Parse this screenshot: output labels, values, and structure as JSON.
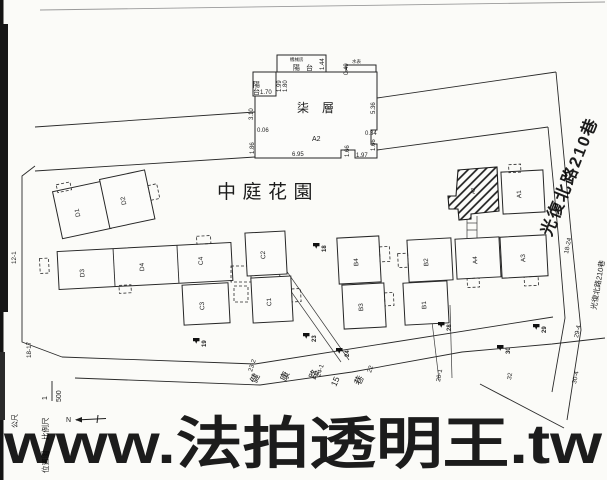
{
  "colors": {
    "watermark_yellow": "#ffe800",
    "street_magenta": "#ea4fd2",
    "courtyard_green": "#6fdb6f",
    "ink": "#1c1c1c"
  },
  "watermark": {
    "text": "www.法拍透明王.tw"
  },
  "floorplan": {
    "floor_label": "柒層",
    "unit_label": "A2",
    "balcony_top": "陽台",
    "balcony_left": "陽台",
    "machine_room": "機械房",
    "water_meter": "水表",
    "dims": {
      "bal_left_w": "1.70",
      "bal_left_d1": "1.99",
      "bal_left_d2": "1.80",
      "bal_top_d": "1.44",
      "top_right": "0.49",
      "left_top": "3.10",
      "left_mid": "0.06",
      "left_bot": "1.86",
      "right_side": "5.36",
      "right_step": "0.34",
      "right_bot": "1.66",
      "bottom": "6.95",
      "bottom_step": "1.66",
      "bottom_right": "1.97"
    }
  },
  "site": {
    "courtyard_label": "中庭花園",
    "street_magenta": "光復北路210巷",
    "street_small": "光復北路210巷",
    "road_chars": [
      "健",
      "康",
      "路",
      "15",
      "巷"
    ],
    "buildings": [
      {
        "id": "D1"
      },
      {
        "id": "D2"
      },
      {
        "id": "D3"
      },
      {
        "id": "D4"
      },
      {
        "id": "C4"
      },
      {
        "id": "C3"
      },
      {
        "id": "C2"
      },
      {
        "id": "C1"
      },
      {
        "id": "B4"
      },
      {
        "id": "B3"
      },
      {
        "id": "B2"
      },
      {
        "id": "B1"
      },
      {
        "id": "A4"
      },
      {
        "id": "A3"
      },
      {
        "id": "A1"
      },
      {
        "id": "A2"
      }
    ],
    "poles": [
      {
        "no": "18"
      },
      {
        "no": "19"
      },
      {
        "no": "23"
      },
      {
        "no": "24"
      },
      {
        "no": "28"
      },
      {
        "no": "29"
      },
      {
        "no": "30"
      }
    ],
    "lots": [
      {
        "no": "12-1"
      },
      {
        "no": "18-17"
      },
      {
        "no": "23-2"
      },
      {
        "no": "24-1"
      },
      {
        "no": "22"
      },
      {
        "no": "26-1"
      },
      {
        "no": "18-24"
      },
      {
        "no": "29-4"
      },
      {
        "no": "30-4"
      },
      {
        "no": "32"
      }
    ]
  },
  "legend": {
    "map_type": "位置圖",
    "scale_label": "比例尺",
    "scale_num": "1",
    "scale_den": "500",
    "unit": "公尺",
    "north": "N"
  }
}
